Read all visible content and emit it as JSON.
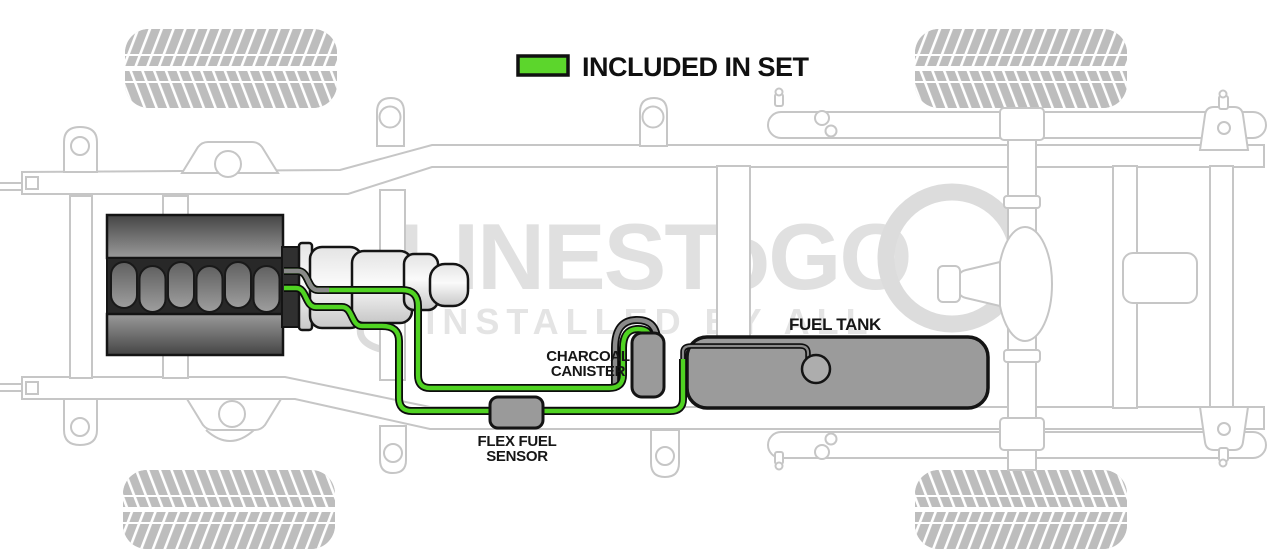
{
  "legend": {
    "label": "INCLUDED IN SET",
    "swatch_color": "#5cd62c"
  },
  "watermark": {
    "brand": "LINESToGO",
    "tagline": "INSTALLED BY ALL"
  },
  "diagram": {
    "labels": {
      "charcoal_canister_line1": "CHARCOAL",
      "charcoal_canister_line2": "CANISTER",
      "fuel_tank": "FUEL TANK",
      "flex_fuel_sensor_line1": "FLEX FUEL",
      "flex_fuel_sensor_line2": "SENSOR"
    },
    "colors": {
      "included_line_green": "#50d322",
      "excluded_line_gray": "#8a8a8a",
      "component_gray": "#9a9a9a",
      "chassis_outline": "#c6c6c6",
      "watermark_gray": "#e0e0e0"
    }
  }
}
